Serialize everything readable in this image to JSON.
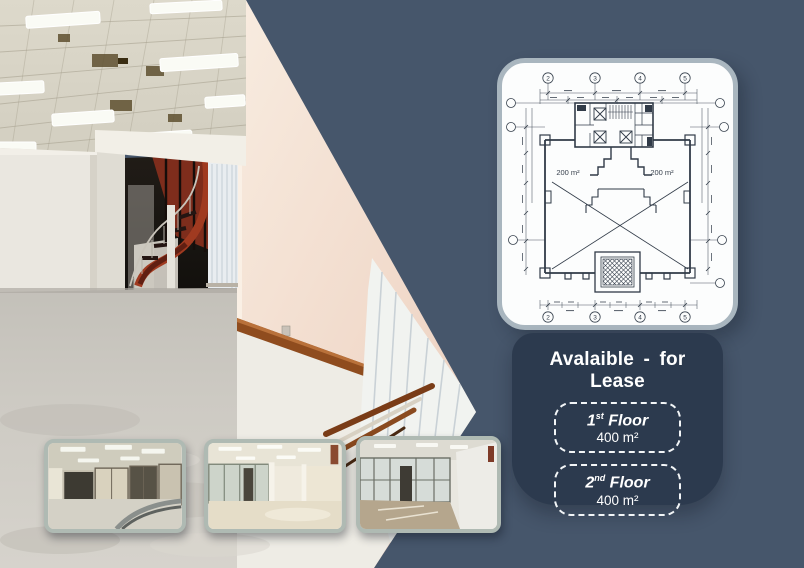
{
  "colors": {
    "background": "#46566B",
    "lease_panel": "#2C3A4E",
    "card_fill": "#FCFDFD",
    "card_border": "#A9B6BF",
    "thumb_border": "#AFBAB3",
    "plan_line": "#313B48",
    "stair_red": "#8C3522",
    "wall_pink": "#F3E2D5"
  },
  "plan": {
    "grid_top": [
      "2",
      "3",
      "4",
      "5"
    ],
    "grid_bottom": [
      "2",
      "3",
      "4",
      "5"
    ],
    "area_left": "200 m²",
    "area_right": "200 m²"
  },
  "lease": {
    "title": "Avalaible - for Lease",
    "floors": [
      {
        "num": "1",
        "suffix": "st",
        "word": "Floor",
        "area": "400 m²"
      },
      {
        "num": "2",
        "suffix": "nd",
        "word": "Floor",
        "area": "400 m²"
      }
    ]
  },
  "images": {
    "main_photo": "empty-office-interior-with-red-spiral-staircase",
    "thumb_1": "office-interior-glass-partitions-railing",
    "thumb_2": "open-office-floor-partitions",
    "thumb_3": "office-corridor-glass-rooms"
  }
}
